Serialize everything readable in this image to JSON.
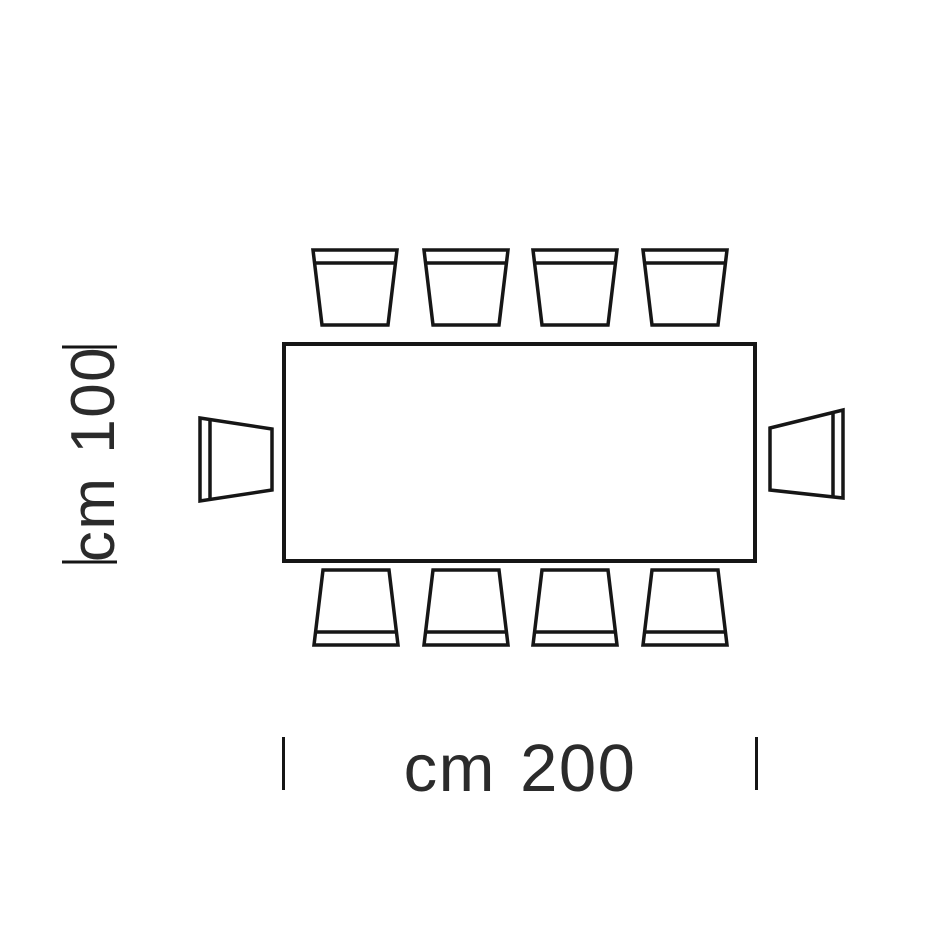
{
  "diagram": {
    "kind": "furniture-top-view-dimension-drawing",
    "subject": "rectangular table with chairs",
    "dimensions": {
      "width_label": "cm 200",
      "depth_label": "cm 100"
    },
    "chairs": {
      "top": 4,
      "bottom": 4,
      "left": 1,
      "right": 1,
      "total": 10
    },
    "colors": {
      "line": "#161616",
      "text": "#2b2b2b",
      "background": "#ffffff"
    }
  }
}
